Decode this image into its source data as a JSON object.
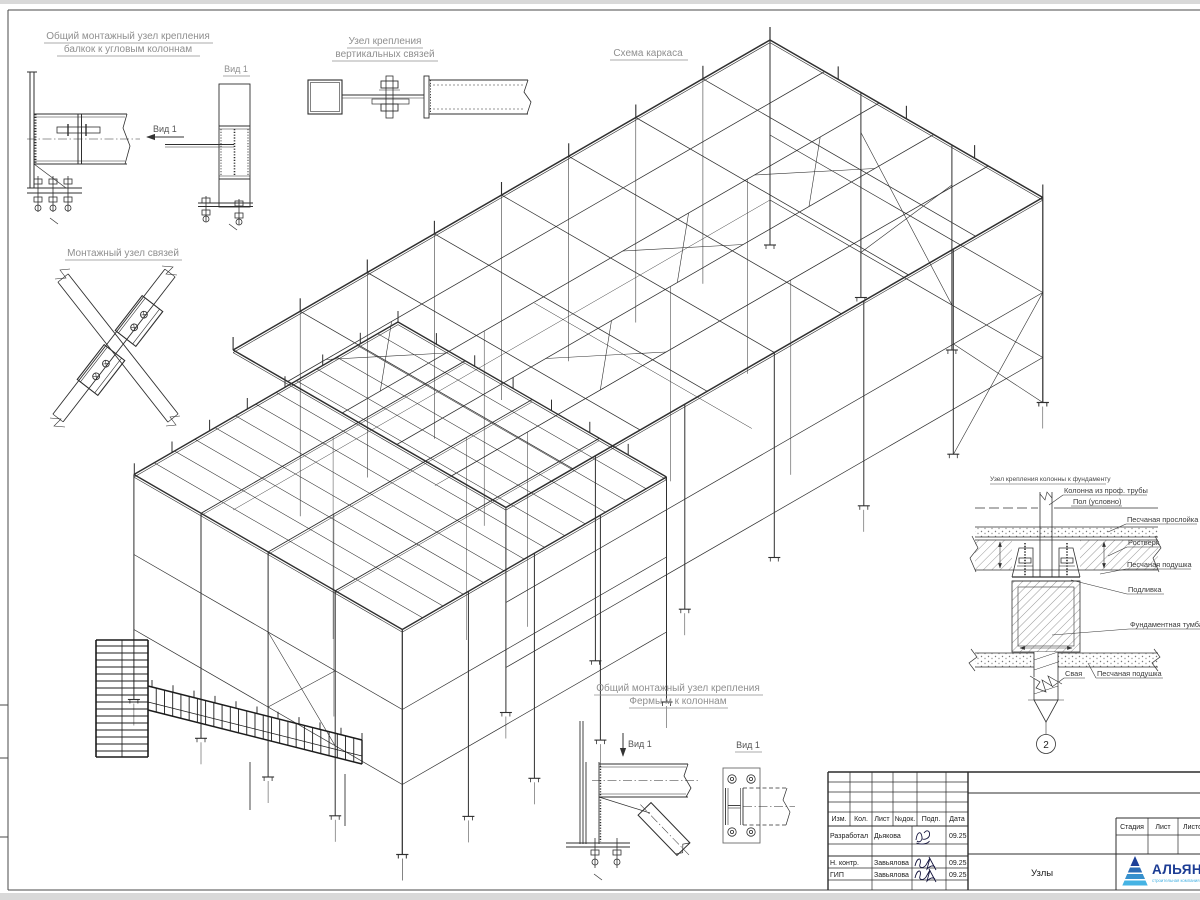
{
  "details": {
    "corner_beam": {
      "title1": "Общий монтажный узел крепления",
      "title2": "балкок к угловым колоннам",
      "view_arrow": "Вид 1",
      "view_title": "Вид 1"
    },
    "vert_braces": {
      "title1": "Узел крепления",
      "title2": "вертикальных связей"
    },
    "braces": {
      "title": "Монтажный узел связей"
    },
    "scheme": {
      "title": "Схема каркаса"
    },
    "foundation": {
      "title": "Узел крепления колонны к фундаменту",
      "column": "Колонна из проф. трубы",
      "floor": "Пол (условно)",
      "sand_layer": "Песчаная прослойка",
      "grillage": "Ростверк",
      "sand_cushion": "Песчаная подушка",
      "grout": "Подливка",
      "pedestal": "Фундаментная тумба",
      "pile": "Свая",
      "sand_cushion2": "Песчаная подушка",
      "marker": "2"
    },
    "truss": {
      "title1": "Общий монтажный узел крепления",
      "title2": "Фермы м к колоннам",
      "view_arrow": "Вид 1",
      "view_title": "Вид 1"
    }
  },
  "title_block": {
    "headers": [
      "Изм.",
      "Кол.",
      "Лист",
      "№док.",
      "Подп.",
      "Дата"
    ],
    "rows": [
      {
        "role": "Разработал",
        "name": "Дьякова",
        "date": "09.25"
      },
      {
        "role": "Н. контр.",
        "name": "Завьялова",
        "date": "09.25"
      },
      {
        "role": "ГИП",
        "name": "Завьялова",
        "date": "09.25"
      }
    ],
    "sheet_name": "Узлы",
    "stage": [
      "Стадия",
      "Лист",
      "Листов"
    ],
    "logo": {
      "name": "АЛЬЯНС",
      "subtitle": "строительная компания",
      "brand_navy": "#1c3c94",
      "brand_blue": "#43b0e2"
    }
  }
}
